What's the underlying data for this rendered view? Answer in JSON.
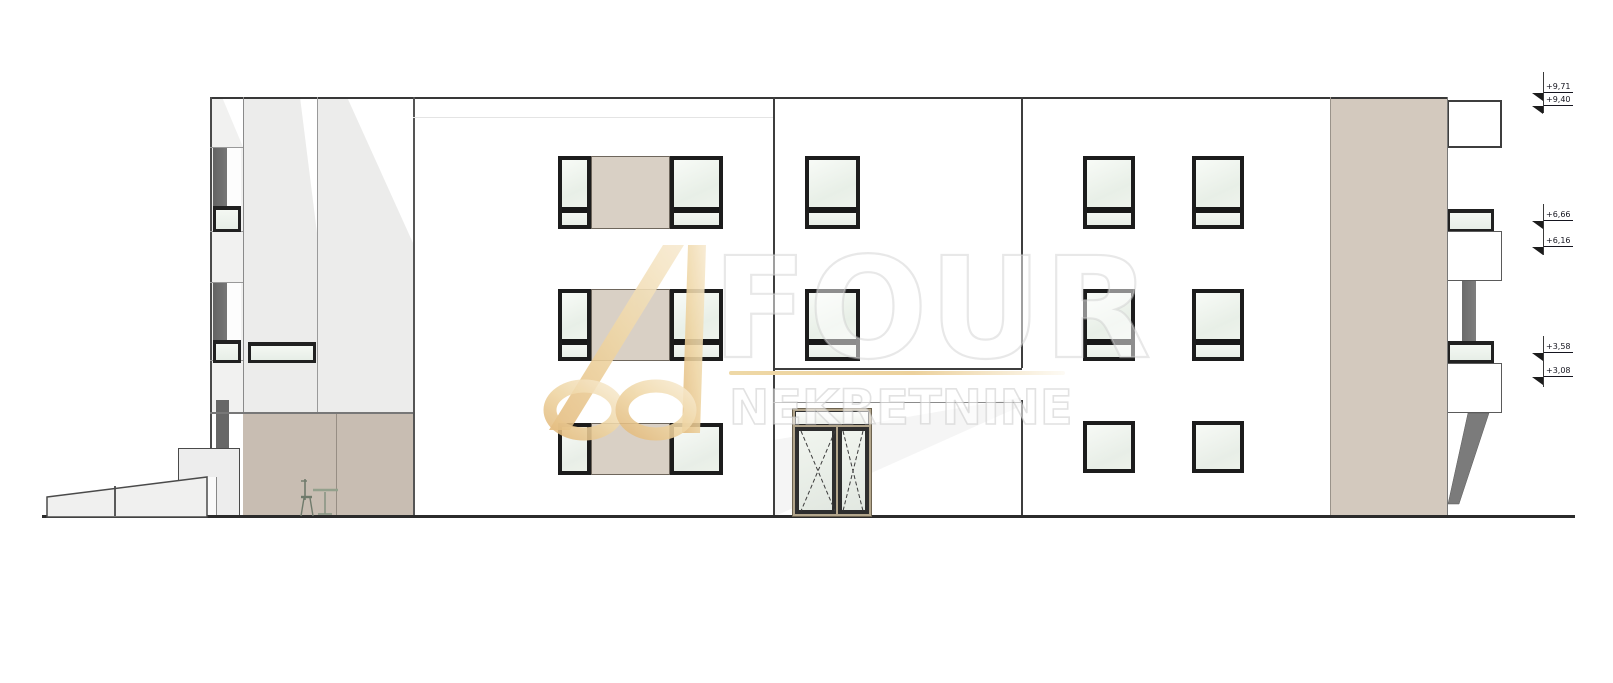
{
  "watermark": {
    "brand": "FOUR",
    "brand_sub": "NEKRETNINE"
  },
  "markers": {
    "labels": [
      "+9,71",
      "+9,40",
      "+6,66",
      "+6,16",
      "+3,58",
      "+3,08"
    ]
  },
  "palette": {
    "facade_white": "#ffffff",
    "panel_gray": "#ececeb",
    "accent_taupe": "#d9d0c5",
    "ground_floor_taupe": "#c8bdb2",
    "right_band_taupe": "#d3c9be",
    "window_frame_dark": "#1c1c1c",
    "glass": "#edf3ec",
    "recess_gray": "#6f6f6f",
    "logo_gold": "#e9cd96",
    "ground_line": "#2b2b2b"
  }
}
